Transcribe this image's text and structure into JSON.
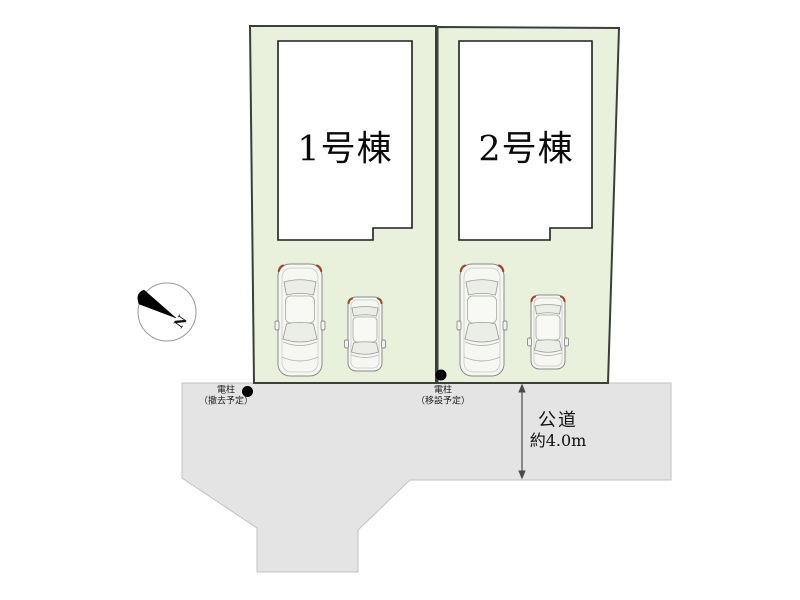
{
  "buildings": [
    {
      "label": "1号棟"
    },
    {
      "label": "2号棟"
    }
  ],
  "poles": [
    {
      "name": "電柱",
      "note": "（撤去予定）"
    },
    {
      "name": "電柱",
      "note": "（移設予定）"
    }
  ],
  "road": {
    "name": "公道",
    "width": "約4.0m"
  },
  "compass": {
    "label": "N"
  },
  "colors": {
    "lot_green": "#e9f1dc",
    "lot_border": "#3a3f38",
    "road_gray": "#e4e4e4",
    "road_border": "#c2c2c2",
    "building_fill": "#ffffff",
    "building_border": "#1f1f1f",
    "pole_dot": "#000000",
    "taillight_red": "#a0492e",
    "arrow_gray": "#4a4a4a"
  }
}
